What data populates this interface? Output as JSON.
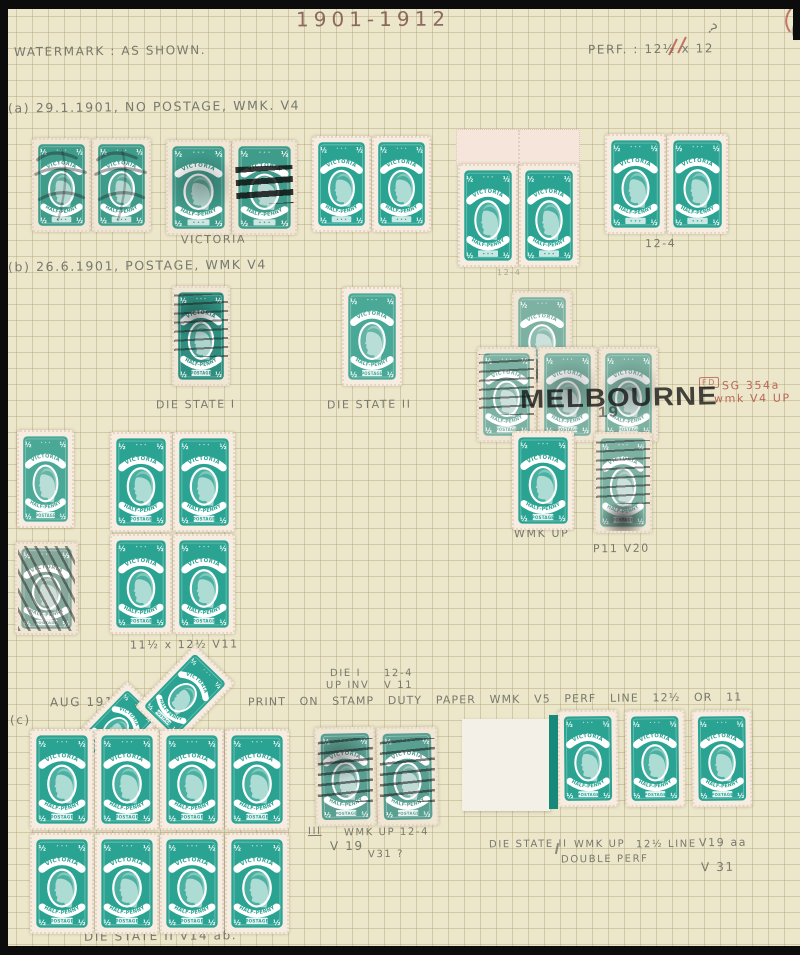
{
  "page": {
    "title": "1901-1912",
    "watermark_note": "WATERMARK : AS SHOWN.",
    "perf_note": "PERF. : 12½ x 12"
  },
  "design": {
    "country": "VICTORIA",
    "denomination": "HALF-PENNY",
    "half": "½",
    "postage": "POSTAGE",
    "cancel_town": "MELBOURNE",
    "cancel_fragment": "19"
  },
  "colors": {
    "page_bg": "#ece7ca",
    "stamp_mint": "#2aa392",
    "stamp_mint2": "#4aa897",
    "stamp_used": "#3f9c8b",
    "stamp_used2": "#5aa092",
    "stamp_pale": "#7db2a3",
    "stamp_dark": "#2e8f80",
    "stamp_grey": "#86a89b",
    "paper": "#f6ece0",
    "paper_worn": "#efe6d3",
    "pencil": "#6f6f66",
    "red_pencil": "#b0493f",
    "margin_stripe": "#17897b"
  },
  "labels": [
    {
      "t": "WATERMARK : AS SHOWN.",
      "x": 14,
      "y": 44,
      "s": 12
    },
    {
      "t": "PERF. : 12½ x 12",
      "x": 588,
      "y": 42,
      "s": 12
    },
    {
      "t": "?",
      "x": 708,
      "y": 22,
      "s": 14,
      "r": 38
    },
    {
      "t": "(a) 29.1.1901, NO POSTAGE, WMK. V4",
      "x": 8,
      "y": 99,
      "s": 12.5
    },
    {
      "t": "VICTORIA",
      "x": 181,
      "y": 233,
      "s": 11
    },
    {
      "t": "12-4",
      "x": 497,
      "y": 268,
      "s": 8,
      "c": "faint"
    },
    {
      "t": "12-4",
      "x": 645,
      "y": 237,
      "s": 11
    },
    {
      "t": "(b) 26.6.1901, POSTAGE, WMK V4",
      "x": 8,
      "y": 258,
      "s": 12.5
    },
    {
      "t": "DIE STATE I",
      "x": 156,
      "y": 398,
      "s": 11
    },
    {
      "t": "DIE STATE II",
      "x": 327,
      "y": 398,
      "s": 11
    },
    {
      "t": "FD",
      "x": 699,
      "y": 377,
      "s": 8,
      "c": "redbox"
    },
    {
      "t": "SG 354a",
      "x": 722,
      "y": 379,
      "s": 11,
      "c": "red"
    },
    {
      "t": "wmk V4 UP",
      "x": 714,
      "y": 392,
      "s": 11,
      "c": "red"
    },
    {
      "t": "WMK UP",
      "x": 514,
      "y": 527,
      "s": 11
    },
    {
      "t": "P11 V20",
      "x": 593,
      "y": 542,
      "s": 11
    },
    {
      "t": "11½ x 12½  V11",
      "x": 130,
      "y": 638,
      "s": 11
    },
    {
      "t": "DIE I",
      "x": 330,
      "y": 668,
      "s": 10
    },
    {
      "t": "12-4",
      "x": 384,
      "y": 668,
      "s": 10
    },
    {
      "t": "UP INV",
      "x": 326,
      "y": 680,
      "s": 10
    },
    {
      "t": "V 11",
      "x": 384,
      "y": 680,
      "s": 10
    },
    {
      "t": "AUG 1912",
      "x": 50,
      "y": 695,
      "s": 12
    },
    {
      "t": "PRINT ON STAMP DUTY PAPER  WMK V5  PERF LINE 12½ OR 11",
      "x": 248,
      "y": 693,
      "s": 11,
      "c": "spread"
    },
    {
      "t": "(c)",
      "x": 10,
      "y": 713,
      "s": 12
    },
    {
      "t": "III",
      "x": 308,
      "y": 826,
      "s": 10,
      "c": "underline"
    },
    {
      "t": "WMK UP 12-4",
      "x": 344,
      "y": 827,
      "s": 10
    },
    {
      "t": "V 19",
      "x": 330,
      "y": 839,
      "s": 12
    },
    {
      "t": "V31 ?",
      "x": 368,
      "y": 849,
      "s": 10
    },
    {
      "t": "DIE STATE II",
      "x": 489,
      "y": 839,
      "s": 10
    },
    {
      "t": "WMK UP",
      "x": 574,
      "y": 839,
      "s": 10
    },
    {
      "t": "12½ LINE",
      "x": 636,
      "y": 839,
      "s": 10
    },
    {
      "t": "V19 aa",
      "x": 699,
      "y": 836,
      "s": 11
    },
    {
      "t": "DOUBLE PERF",
      "x": 561,
      "y": 854,
      "s": 10
    },
    {
      "t": "V 31",
      "x": 701,
      "y": 860,
      "s": 12
    },
    {
      "t": "DIE STATE II  V14 ab.",
      "x": 84,
      "y": 929,
      "s": 12
    }
  ],
  "stamp_groups": [
    {
      "n": "pair-a-used-1",
      "x": 32,
      "y": 138,
      "cols": 2,
      "w": 59,
      "h": 94,
      "v": "used",
      "p": false,
      "cx": [
        "scribble",
        "scribble"
      ]
    },
    {
      "n": "pair-a-used-2",
      "x": 166,
      "y": 140,
      "cols": 2,
      "w": 65,
      "h": 95,
      "v": "used",
      "p": false,
      "cx": [
        "smear",
        "bars"
      ]
    },
    {
      "n": "pair-a-mint-1",
      "x": 312,
      "y": 136,
      "cols": 2,
      "w": 59,
      "h": 96,
      "v": "mint",
      "p": false,
      "cx": [
        "",
        ""
      ]
    },
    {
      "n": "pair-a-margin",
      "x": 458,
      "y": 164,
      "cols": 2,
      "w": 60,
      "h": 103,
      "v": "mint",
      "p": false,
      "cx": [
        "",
        ""
      ]
    },
    {
      "n": "pair-a-mint-2",
      "x": 605,
      "y": 134,
      "cols": 2,
      "w": 61,
      "h": 100,
      "v": "mint",
      "p": false,
      "cx": [
        "",
        ""
      ]
    },
    {
      "n": "single-die-state-1",
      "x": 172,
      "y": 286,
      "w": 58,
      "h": 100,
      "v": "dark",
      "p": true,
      "cx": [
        "lines smudge"
      ]
    },
    {
      "n": "single-die-state-2",
      "x": 342,
      "y": 287,
      "w": 60,
      "h": 99,
      "v": "mint2",
      "p": true,
      "cx": [
        ""
      ]
    },
    {
      "n": "cluster-top",
      "x": 512,
      "y": 291,
      "w": 60,
      "h": 94,
      "v": "pale",
      "p": true,
      "cx": [
        "blobB"
      ]
    },
    {
      "n": "cluster-middle-row",
      "x": 477,
      "y": 347,
      "cols": 3,
      "w": 59,
      "h": 95,
      "gx": 2,
      "v": "pale",
      "p": true,
      "cx": [
        "lines",
        "smear",
        "smear"
      ]
    },
    {
      "n": "cluster-bottom-mint",
      "x": 512,
      "y": 431,
      "w": 62,
      "h": 99,
      "v": "mint",
      "p": true,
      "cx": [
        ""
      ]
    },
    {
      "n": "cluster-bottom-used",
      "x": 594,
      "y": 432,
      "w": 58,
      "h": 101,
      "v": "pale",
      "p": true,
      "cx": [
        "lines blobB"
      ]
    },
    {
      "n": "single-b-mint",
      "x": 17,
      "y": 430,
      "w": 57,
      "h": 98,
      "v": "mint2",
      "p": true,
      "cx": [
        ""
      ]
    },
    {
      "n": "single-b-used",
      "x": 15,
      "y": 542,
      "w": 63,
      "h": 93,
      "v": "grey",
      "p": true,
      "cx": [
        "hatch"
      ]
    },
    {
      "n": "block-of-4",
      "x": 110,
      "y": 432,
      "cols": 2,
      "rows": 2,
      "w": 62,
      "h": 100,
      "gx": 1,
      "gy": 2,
      "v": "mint",
      "p": true,
      "cx": [
        "",
        "",
        "",
        ""
      ]
    },
    {
      "n": "diamond-left",
      "x": 92,
      "y": 688,
      "w": 52,
      "h": 80,
      "v": "mint",
      "p": true,
      "rot": 44,
      "cx": [
        ""
      ]
    },
    {
      "n": "diamond-main",
      "x": 157,
      "y": 652,
      "w": 56,
      "h": 86,
      "v": "mint",
      "p": true,
      "rot": 44,
      "cx": [
        ""
      ]
    },
    {
      "n": "block-of-8",
      "x": 30,
      "y": 729,
      "cols": 4,
      "rows": 2,
      "w": 64,
      "h": 101,
      "gx": 1,
      "gy": 3,
      "v": "mint",
      "p": true,
      "cx": [
        "",
        "",
        "",
        "",
        "",
        "",
        "",
        ""
      ]
    },
    {
      "n": "pair-c-used",
      "x": 315,
      "y": 727,
      "cols": 2,
      "w": 61,
      "h": 99,
      "v": "used2",
      "p": true,
      "rot": -1,
      "cx": [
        "lines2 smudge",
        "lines2"
      ]
    },
    {
      "n": "strip-of-3",
      "x": 558,
      "y": 710,
      "cols": 3,
      "w": 60,
      "h": 97,
      "gx": 7,
      "v": "mint",
      "p": true,
      "rot": -0.5,
      "cx": [
        "",
        "",
        ""
      ]
    }
  ],
  "pieces": {
    "margin_a": {
      "x": 456,
      "y": 129,
      "w": 122,
      "h": 36
    },
    "margin_c": {
      "x": 462,
      "y": 719,
      "w": 88,
      "h": 92
    },
    "stripe_c": {
      "x": 549,
      "y": 715,
      "w": 9,
      "h": 94
    }
  },
  "overlays": {
    "melbourne": {
      "x": 520,
      "y": 384,
      "size": 26
    },
    "fragment": {
      "x": 598,
      "y": 404,
      "size": 15
    }
  }
}
